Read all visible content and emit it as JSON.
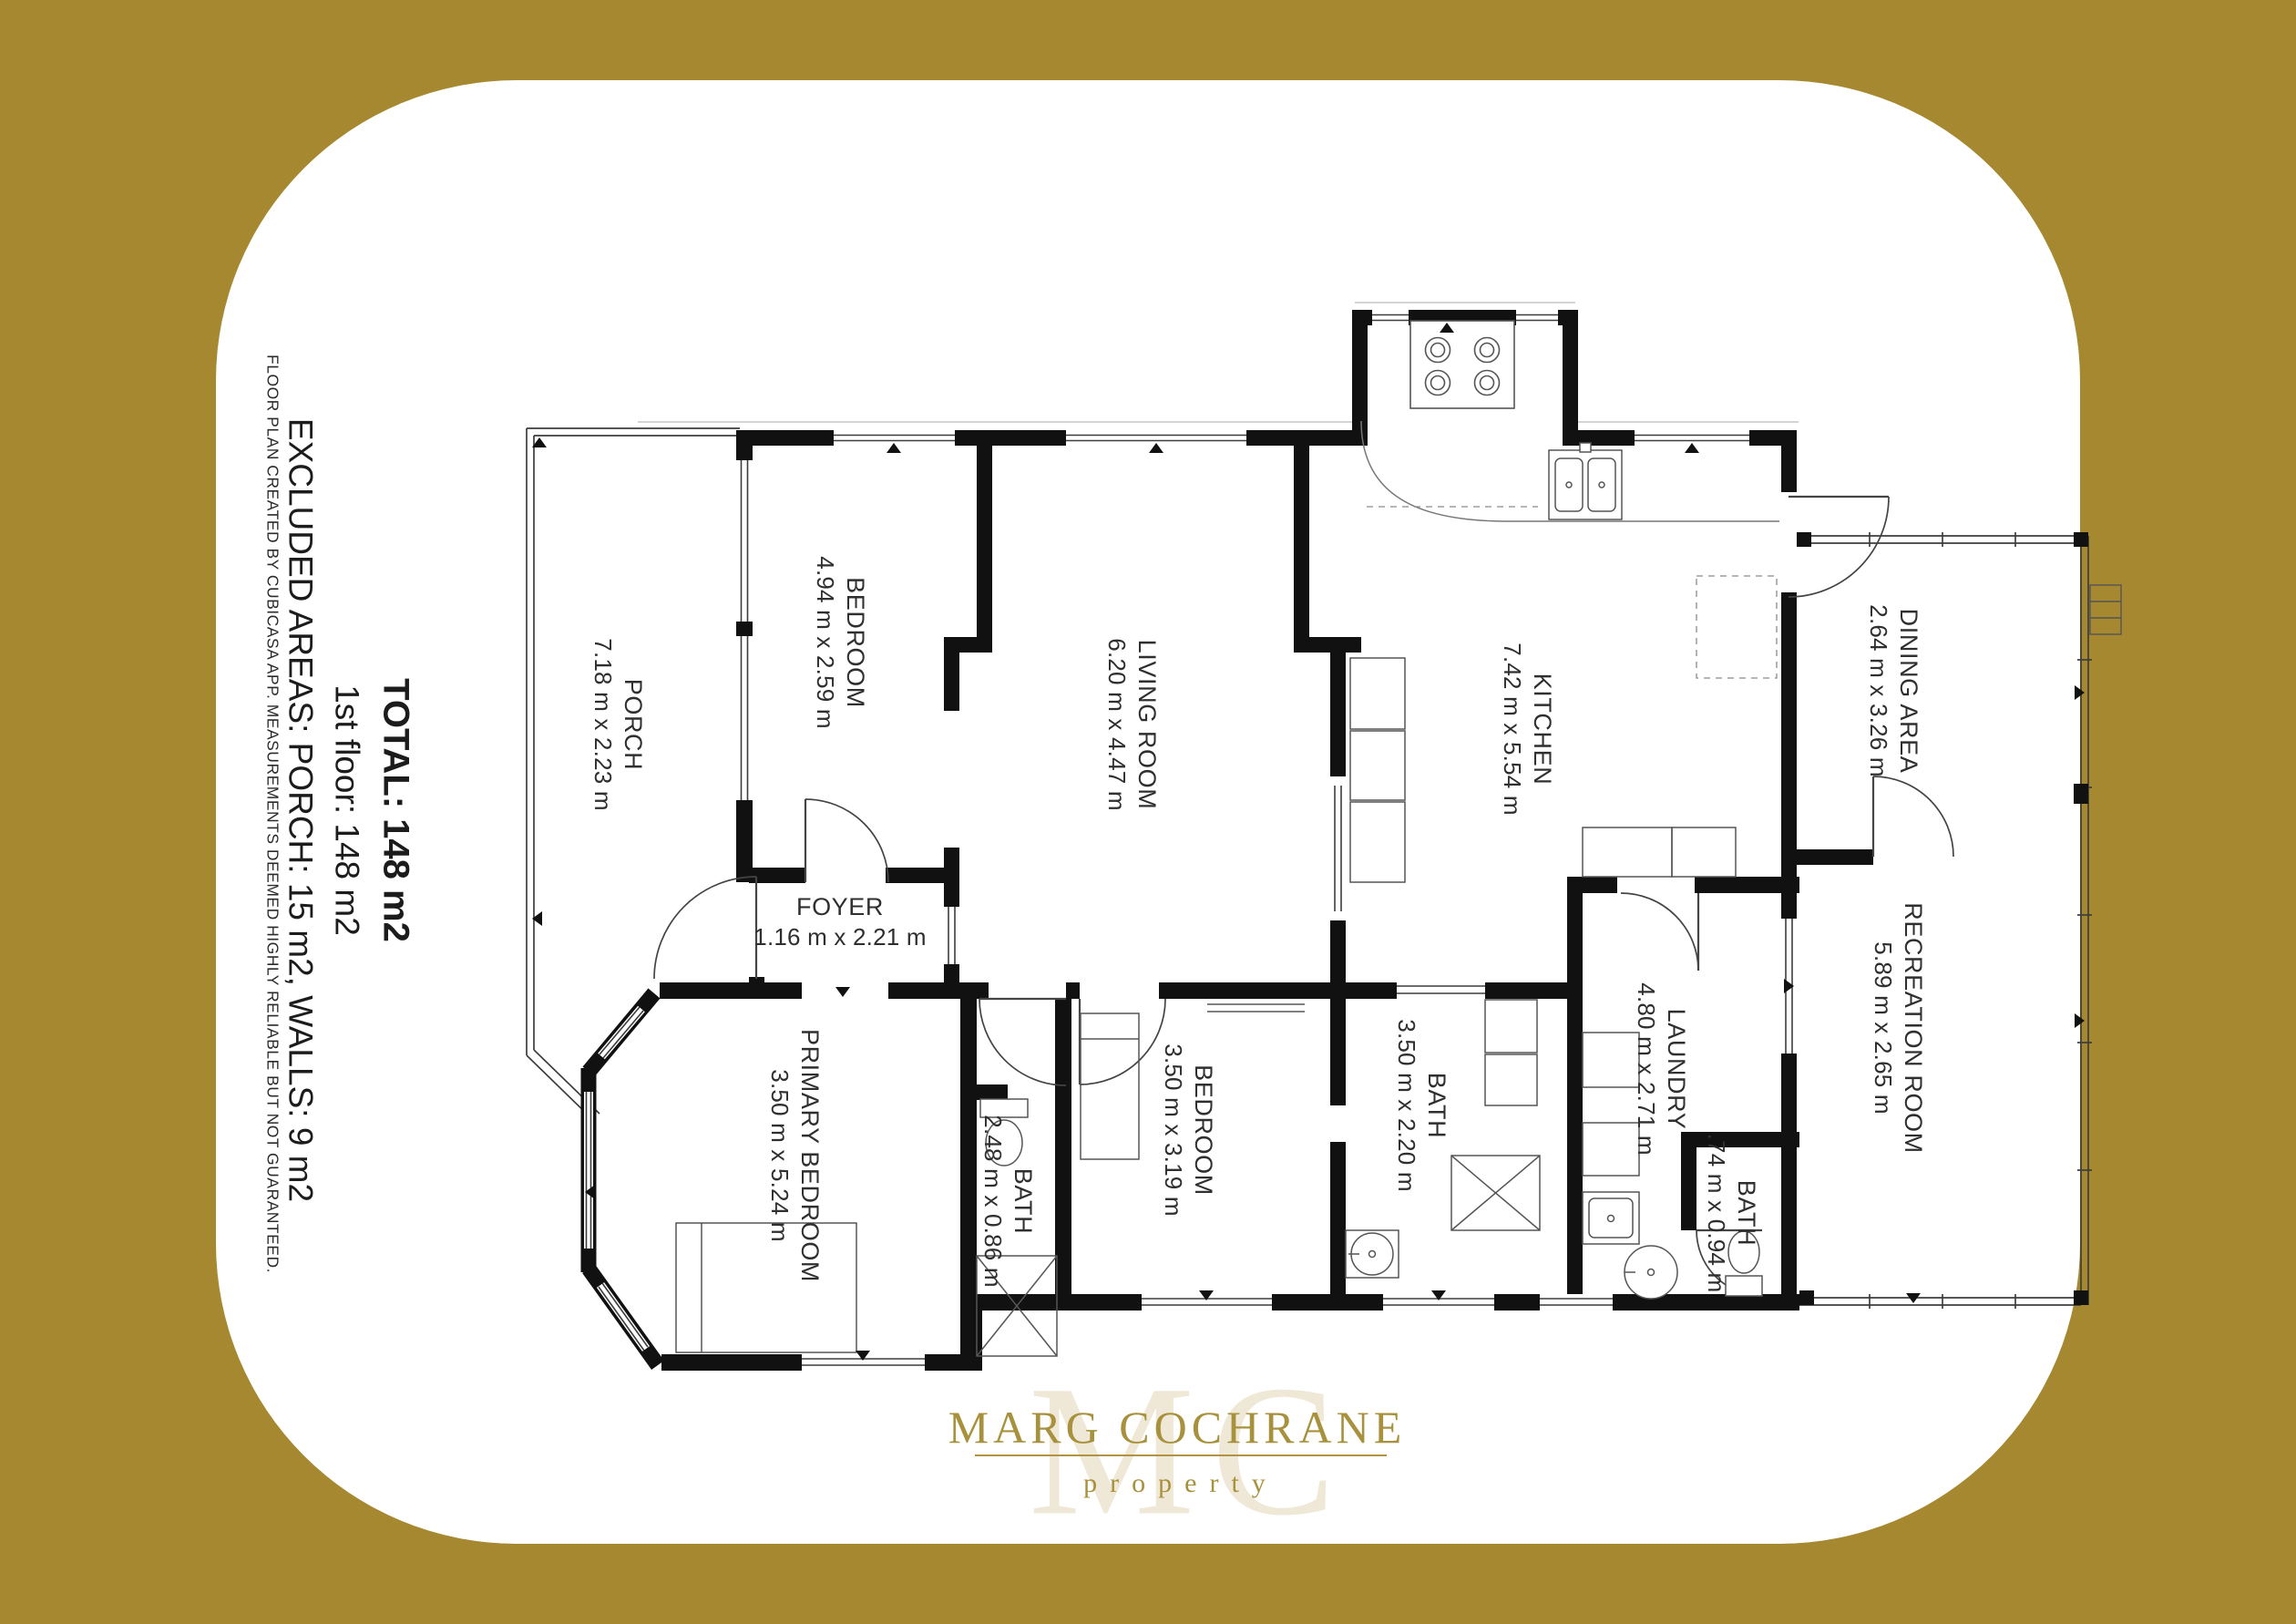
{
  "page": {
    "background_color": "#A5882F",
    "card_color": "#FFFFFF",
    "wall_color": "#111111"
  },
  "summary": {
    "total": "TOTAL: 148 m2",
    "floor": "1st floor: 148 m2",
    "excluded": "EXCLUDED AREAS: PORCH: 15 m2, WALLS: 9 m2",
    "disclaimer": "FLOOR PLAN CREATED BY CUBICASA APP. MEASUREMENTS DEEMED HIGHLY RELIABLE BUT NOT GUARANTEED."
  },
  "rooms": {
    "porch": {
      "name": "PORCH",
      "dims": "7.18 m x 2.23 m"
    },
    "bedroom1": {
      "name": "BEDROOM",
      "dims": "4.94 m x 2.59 m"
    },
    "living": {
      "name": "LIVING ROOM",
      "dims": "6.20 m x 4.47 m"
    },
    "kitchen": {
      "name": "KITCHEN",
      "dims": "7.42 m x 5.54 m"
    },
    "dining": {
      "name": "DINING AREA",
      "dims": "2.64 m x 3.26 m"
    },
    "foyer": {
      "name": "FOYER",
      "dims": "1.16 m x 2.21 m"
    },
    "primary": {
      "name": "PRIMARY BEDROOM",
      "dims": "3.50 m x 5.24 m"
    },
    "bath_hall": {
      "name": "BATH",
      "dims": "2.48 m x 0.86 m"
    },
    "bedroom2": {
      "name": "BEDROOM",
      "dims": "3.50 m x 3.19 m"
    },
    "bath_main": {
      "name": "BATH",
      "dims": "3.50 m x 2.20 m"
    },
    "laundry": {
      "name": "LAUNDRY",
      "dims": "4.80 m x 2.71 m"
    },
    "bath_laundry": {
      "name": "BATH",
      "dims": ".74 m x 0.94 m"
    },
    "recreation": {
      "name": "RECREATION ROOM",
      "dims": "5.89 m x 2.65 m"
    }
  },
  "logo": {
    "brand": "MARG COCHRANE",
    "tagline": "property",
    "monogram_m": "M",
    "monogram_c": "C",
    "gold": "#A8913C",
    "watermark": "#EFE8D7"
  }
}
